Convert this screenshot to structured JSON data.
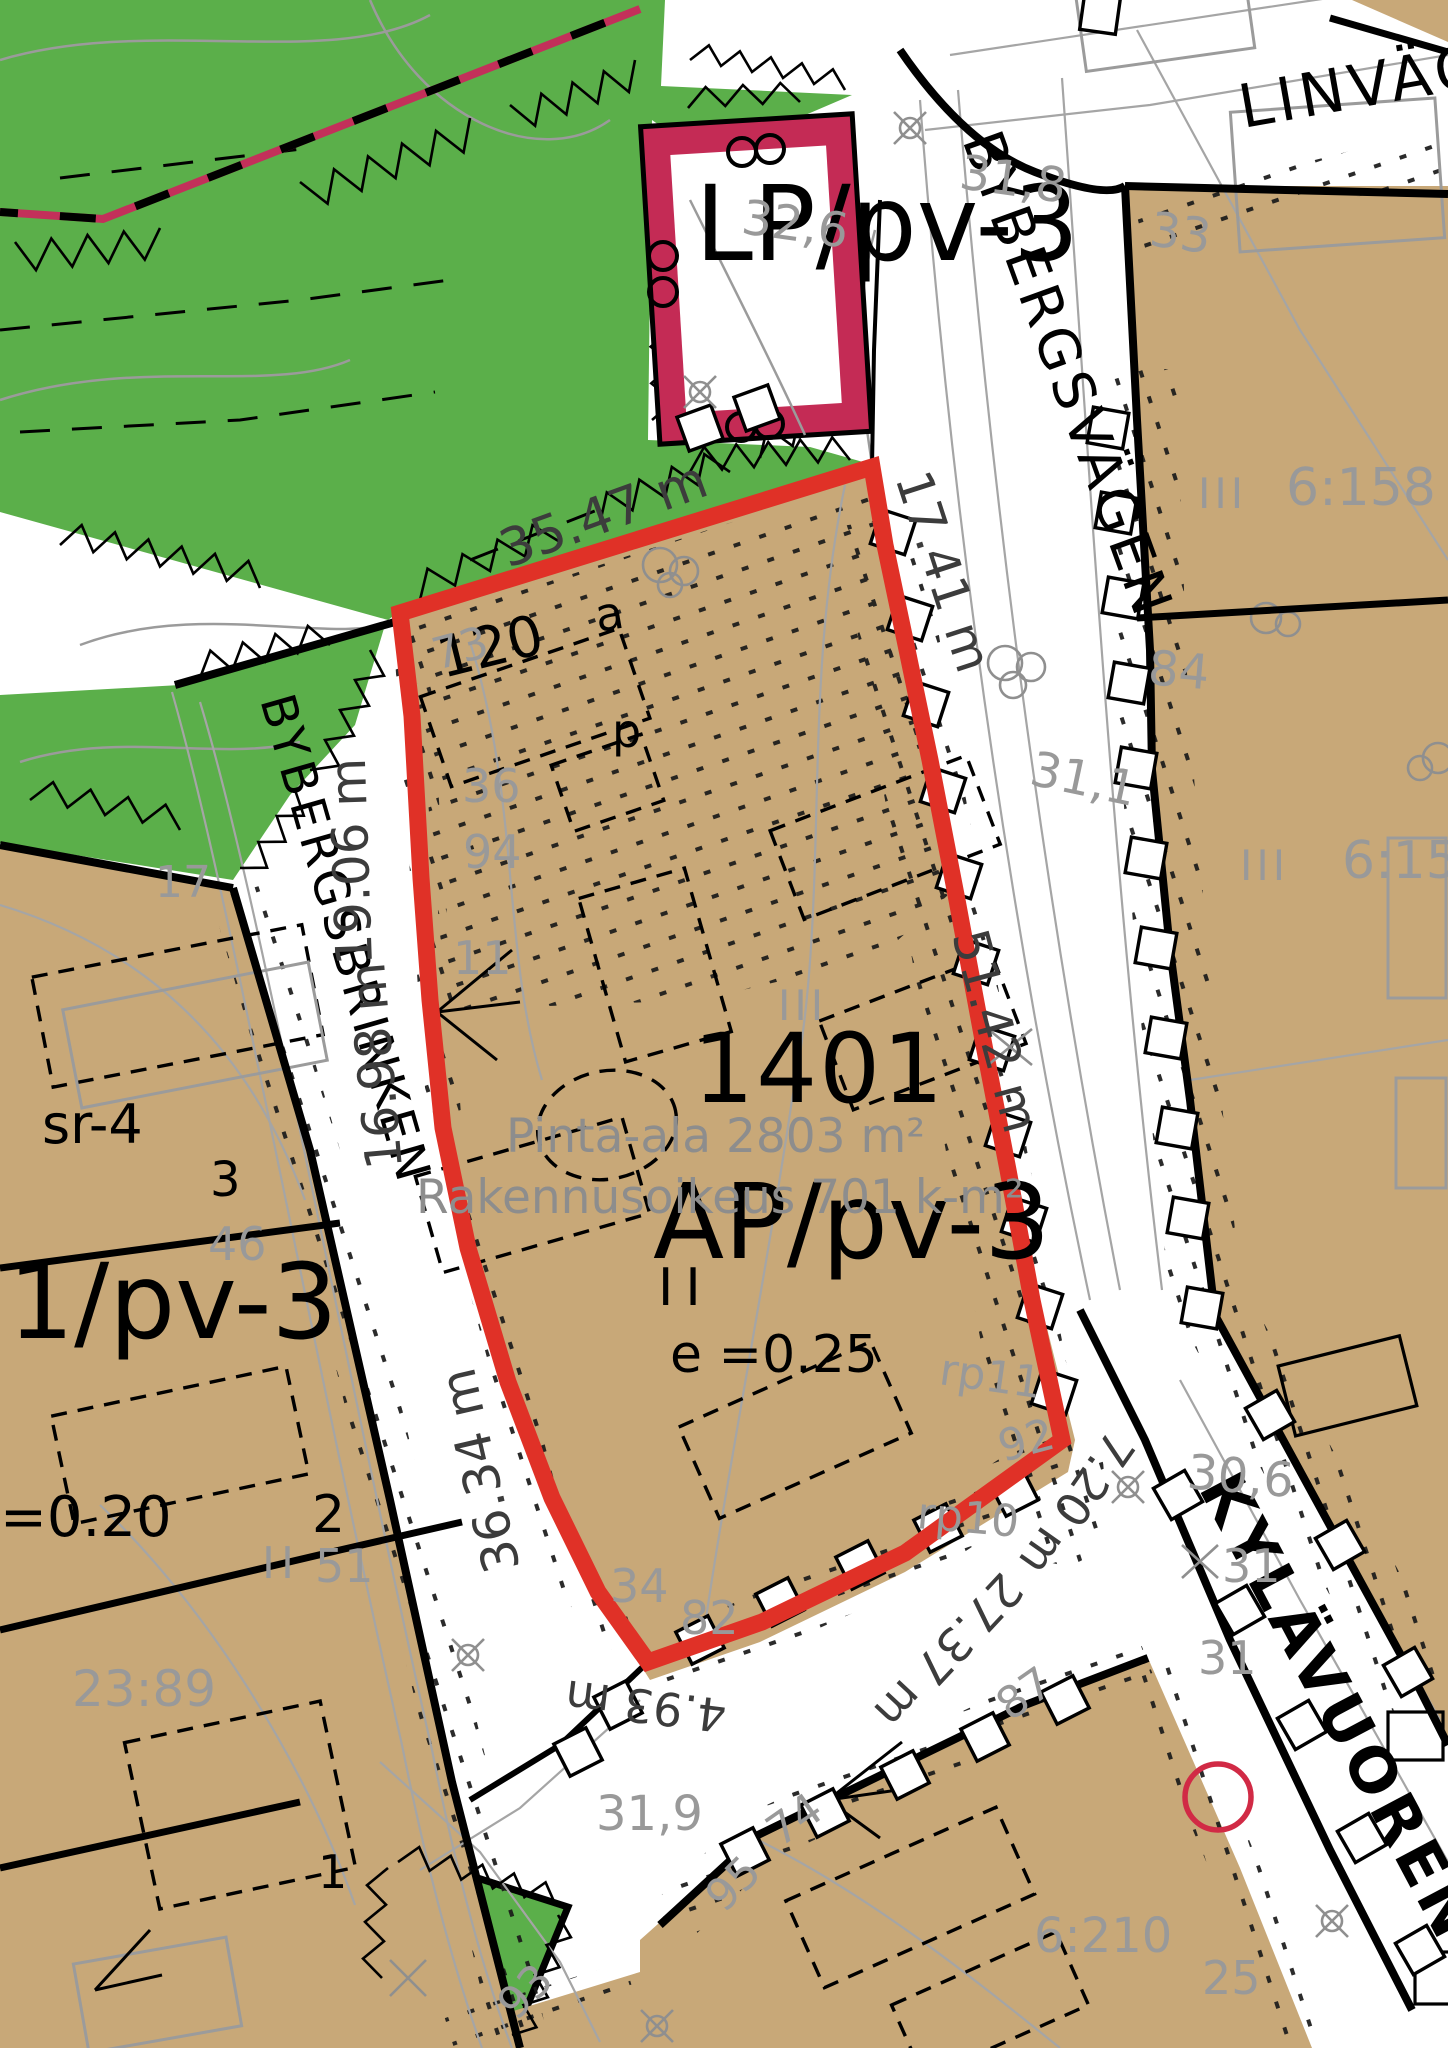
{
  "map": {
    "zoning": {
      "lp": "LP/pv-3",
      "ap": "AP/pv-3",
      "one_pv": "1/pv-3",
      "sr4": "sr-4",
      "e025": "e =0.25",
      "e020": "=0.20",
      "storeys_ii": "II"
    },
    "streets": {
      "linvagen": "LINVÄGEN",
      "bybergsvagen": "BYBERGSVÄGEN",
      "bybergsbrinken": "BYBERGSBRINKEN",
      "kylavuorentie": "KYLÄVUORENTIE"
    },
    "parcel": {
      "id1401": "1401",
      "area": "Pinta-ala 2803 m²",
      "building_right": "Rakennusoikeus 701 k-m²",
      "block120": "120",
      "mark_a": "a",
      "mark_p": "p",
      "n3": "3",
      "n2": "2",
      "n1": "1"
    },
    "measurements": {
      "m3547": "35.47 m",
      "m1741": "17.41 m",
      "m5142": "51.42 m",
      "m1906": "19.06 m",
      "m1698": "16.98 m",
      "m3634": "36.34 m",
      "m493": "4.93 m",
      "m2737": "27.37 m",
      "m720": "7.20 m"
    },
    "survey_numbers": {
      "s318": "31,8",
      "s326": "32,6",
      "s33": "33",
      "s6158": "6:158",
      "s84": "84",
      "s6157": "6:157",
      "s311": "31,1",
      "s17": "17",
      "s73": "73",
      "s36": "36",
      "s94": "94",
      "s11": "11",
      "s46": "46",
      "s51": "51",
      "s2389": "23:89",
      "s34": "34",
      "s82": "82",
      "s92": "92",
      "rp11": "rp11",
      "rp10": "rp10",
      "s306": "30,6",
      "s31a": "31",
      "s31b": "31",
      "s319": "31,9",
      "s74": "74",
      "s95": "95",
      "s87": "87",
      "s93": "93",
      "s6210": "6:210",
      "s25": "25",
      "iii_a": "III",
      "iii_b": "III",
      "iii_c": "III",
      "ii_gray": "II"
    },
    "colors": {
      "forest_green": "#5BAF4A",
      "parcel_tan": "#C8A878",
      "boundary_red": "#E03127",
      "lp_crimson": "#C42B55",
      "gray_text": "#999999",
      "dark_measure": "#3C3C3C"
    }
  }
}
